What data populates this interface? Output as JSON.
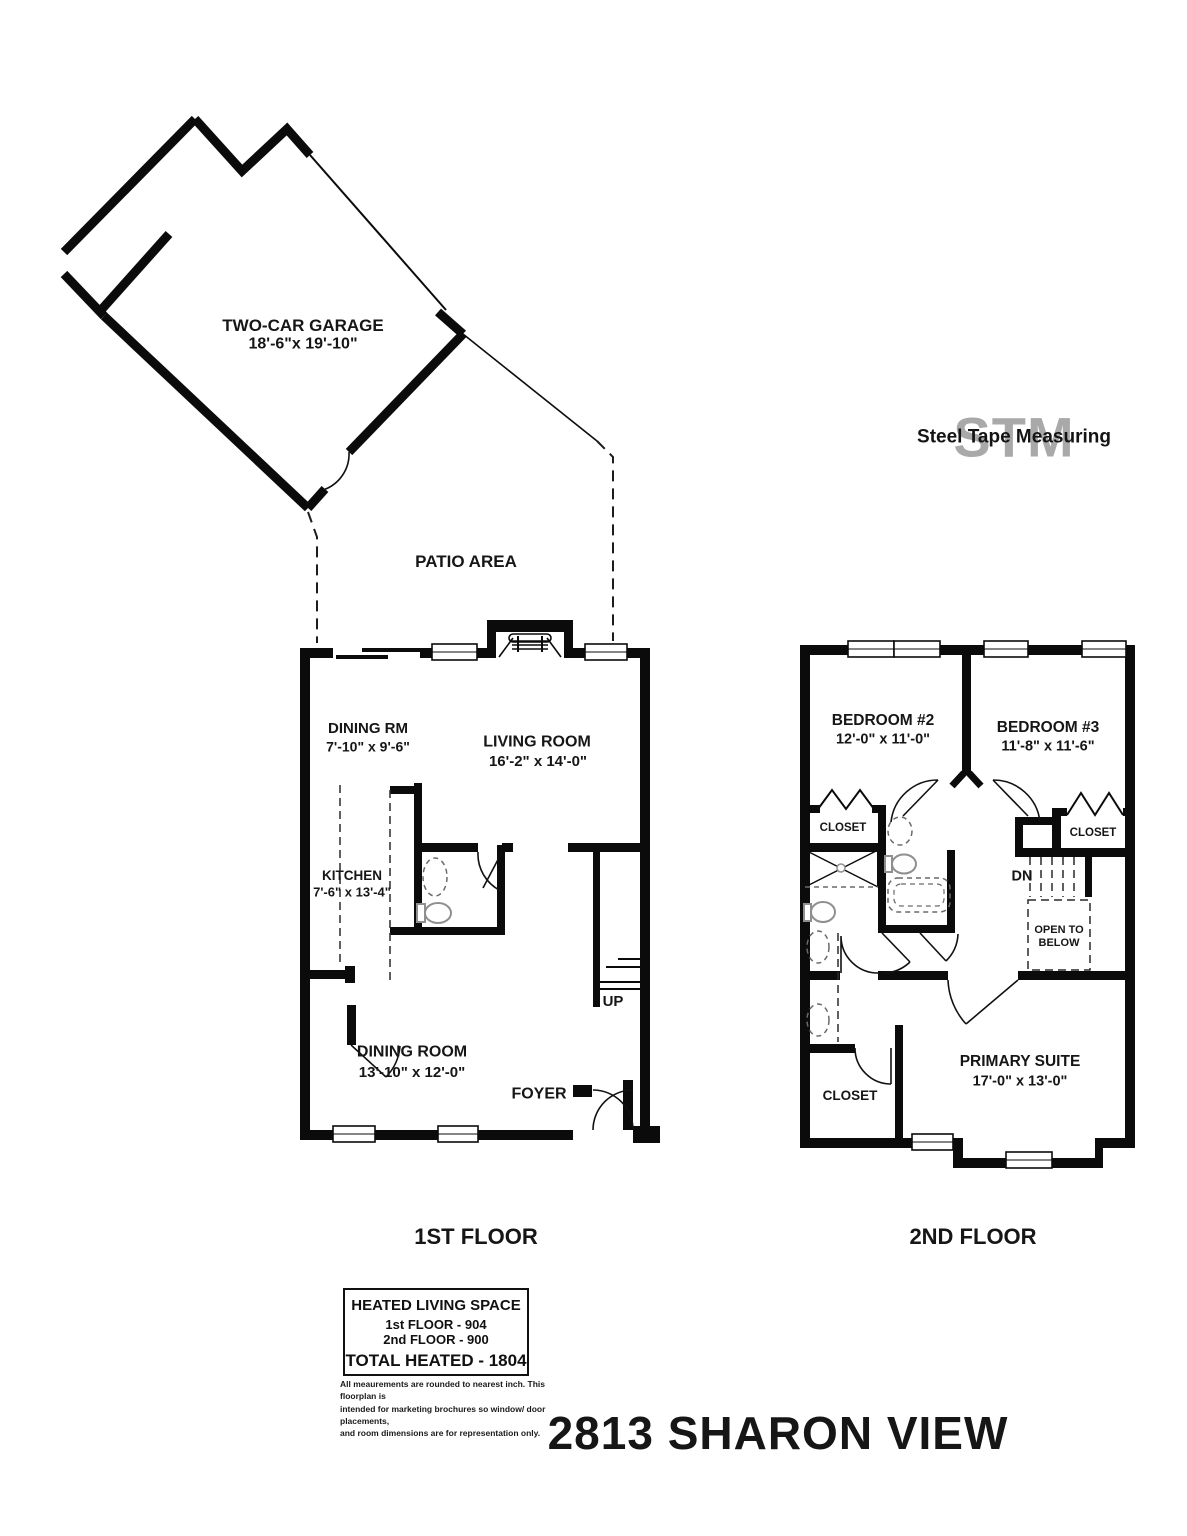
{
  "logo": {
    "stm": "STM",
    "text": "Steel Tape Measuring"
  },
  "garage": {
    "name": "TWO-CAR GARAGE",
    "dims": "18'-6\"x 19'-10\""
  },
  "patio": {
    "label": "PATIO AREA"
  },
  "floor1": {
    "label": "1ST FLOOR",
    "rooms": {
      "dining_rm": {
        "name": "DINING RM",
        "dims": "7'-10\" x 9'-6\""
      },
      "living_room": {
        "name": "LIVING ROOM",
        "dims": "16'-2\" x 14'-0\""
      },
      "kitchen": {
        "name": "KITCHEN",
        "dims": "7'-6\" x 13'-4\""
      },
      "dining_room": {
        "name": "DINING ROOM",
        "dims": "13'-10\" x 12'-0\""
      },
      "foyer": {
        "name": "FOYER"
      },
      "stairs": {
        "label": "UP"
      }
    }
  },
  "floor2": {
    "label": "2ND FLOOR",
    "rooms": {
      "bedroom2": {
        "name": "BEDROOM #2",
        "dims": "12'-0\" x 11'-0\""
      },
      "bedroom3": {
        "name": "BEDROOM #3",
        "dims": "11'-8\" x 11'-6\""
      },
      "closet_left": {
        "name": "CLOSET"
      },
      "closet_right": {
        "name": "CLOSET"
      },
      "closet_primary": {
        "name": "CLOSET"
      },
      "primary_suite": {
        "name": "PRIMARY SUITE",
        "dims": "17'-0\" x 13'-0\""
      },
      "stairs": {
        "label": "DN"
      },
      "open_below": {
        "line1": "OPEN TO",
        "line2": "BELOW"
      }
    }
  },
  "summary": {
    "title": "HEATED LIVING SPACE",
    "line1": "1st FLOOR - 904",
    "line2": "2nd FLOOR - 900",
    "total": "TOTAL HEATED - 1804"
  },
  "disclaimer": {
    "line1": "All meaurements are rounded to nearest inch. This floorplan is",
    "line2": "intended for marketing brochures so window/ door placements,",
    "line3": "and room dimensions are for representation only."
  },
  "address": "2813 SHARON VIEW"
}
